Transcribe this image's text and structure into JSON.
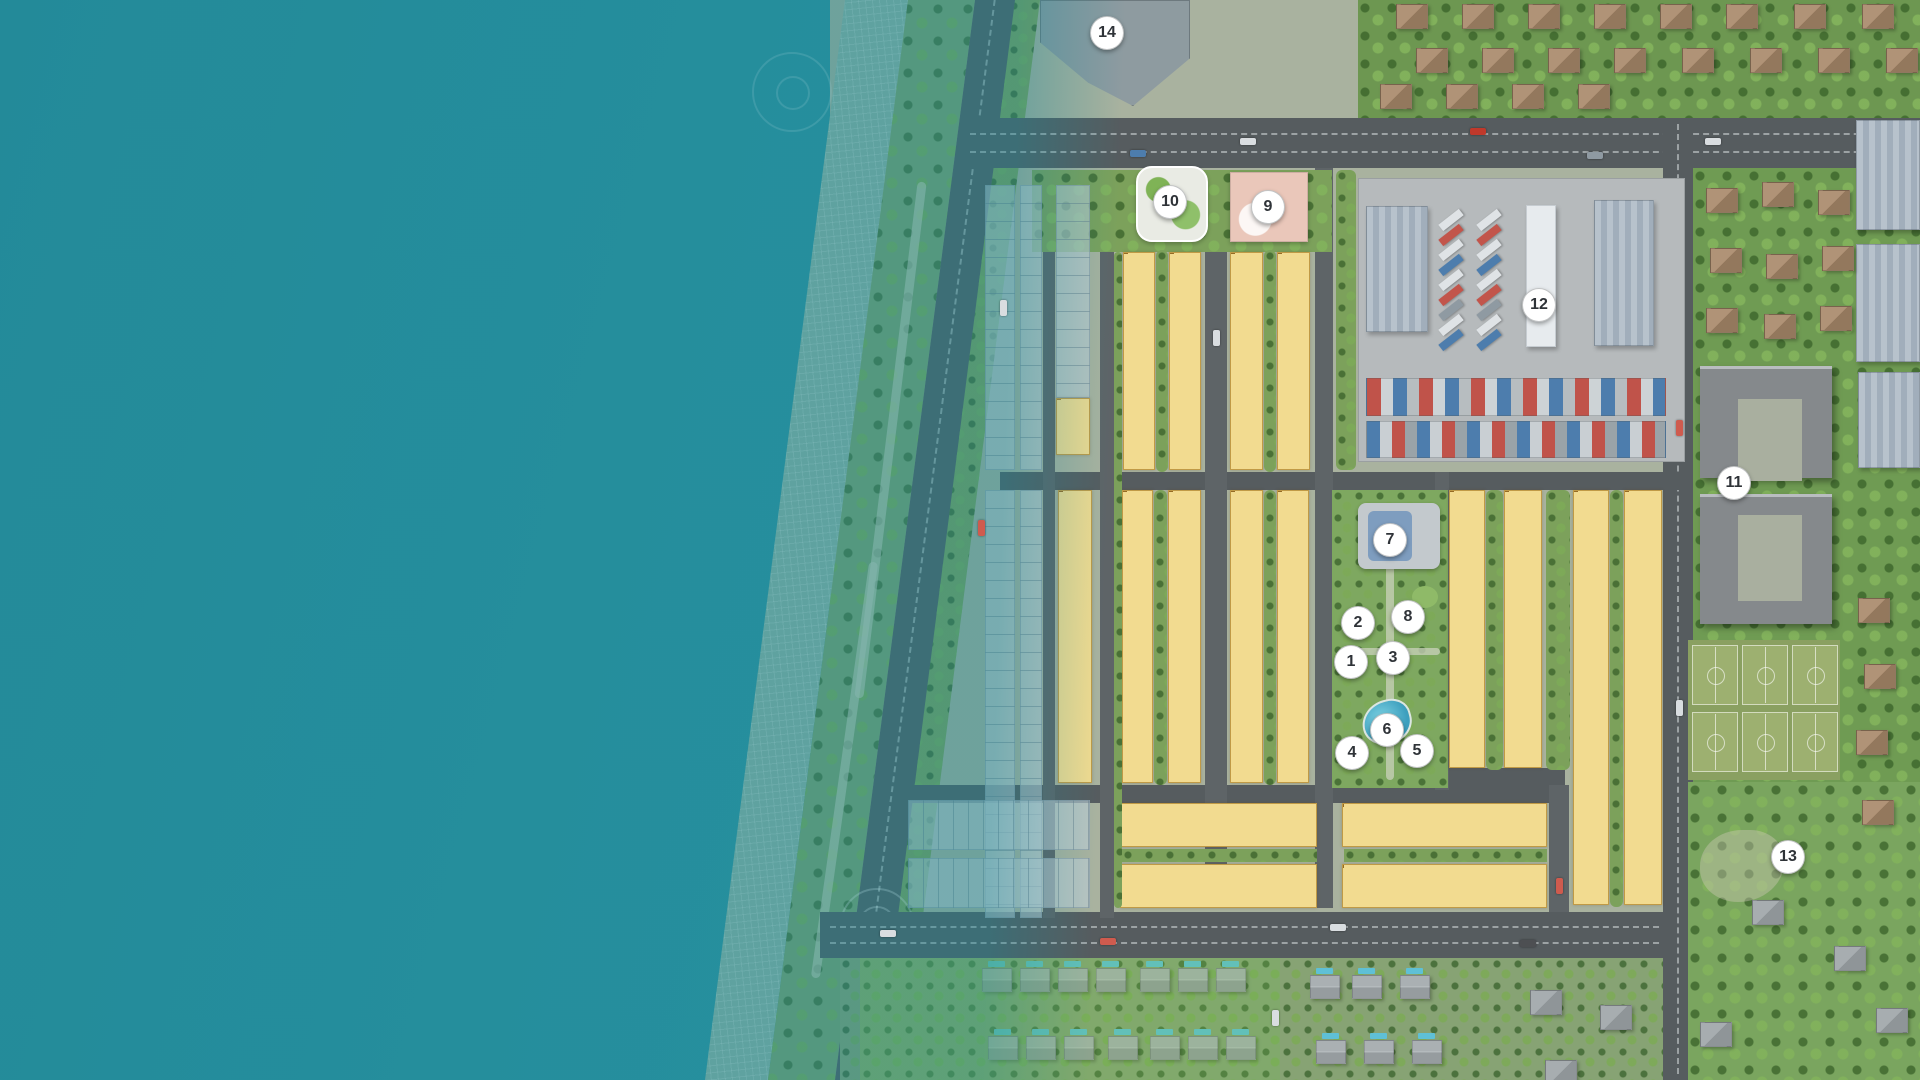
{
  "map_title": "coastal-resort-master-plan",
  "palette": {
    "sea": "#2f93a1",
    "lot_fill": "#f2db90",
    "lot_border": "#c09a46",
    "road": "#565c5f",
    "green": "#7ca15b",
    "marker_bg": "#ffffff",
    "marker_text": "#2f3338",
    "pool": "#5fc0d6",
    "school": "#eac7ba"
  },
  "markers": [
    {
      "num": "1",
      "x": 1351,
      "y": 662
    },
    {
      "num": "2",
      "x": 1358,
      "y": 623
    },
    {
      "num": "3",
      "x": 1393,
      "y": 658
    },
    {
      "num": "4",
      "x": 1352,
      "y": 753
    },
    {
      "num": "5",
      "x": 1417,
      "y": 751
    },
    {
      "num": "6",
      "x": 1387,
      "y": 730
    },
    {
      "num": "7",
      "x": 1390,
      "y": 540
    },
    {
      "num": "8",
      "x": 1408,
      "y": 617
    },
    {
      "num": "9",
      "x": 1268,
      "y": 207
    },
    {
      "num": "10",
      "x": 1170,
      "y": 202
    },
    {
      "num": "11",
      "x": 1734,
      "y": 483
    },
    {
      "num": "12",
      "x": 1539,
      "y": 305
    },
    {
      "num": "13",
      "x": 1788,
      "y": 857
    },
    {
      "num": "14",
      "x": 1107,
      "y": 33
    }
  ],
  "lots": {
    "vstrips": [
      {
        "id": "A",
        "prefix": "A",
        "from": 1,
        "to": 3,
        "value": "165.00",
        "ov": {
          "2": "169.00",
          "3": "256.30"
        }
      },
      {
        "id": "B-a",
        "prefix": "B",
        "from": 1,
        "to": 12,
        "value": "142.50",
        "ov": {
          "12": "165.10"
        }
      },
      {
        "id": "B-b",
        "prefix": "B",
        "from": 13,
        "to": 24,
        "value": "142.50",
        "ov": {
          "24": "169.50"
        }
      },
      {
        "id": "C-a",
        "prefix": "C",
        "from": 1,
        "to": 12,
        "value": "142.50",
        "ov": {
          "12": "165.10"
        }
      },
      {
        "id": "C-b",
        "prefix": "C",
        "from": 13,
        "to": 24,
        "value": "142.50",
        "ov": {
          "24": "189.50"
        }
      },
      {
        "id": "D",
        "prefix": "D",
        "from": 1,
        "to": 16,
        "value": "176.00",
        "ov": {
          "1": "304.70",
          "16": "322.00"
        }
      },
      {
        "id": "E-a",
        "prefix": "E",
        "from": 1,
        "to": 16,
        "value": "142.90",
        "ov": {
          "1": "177.10"
        }
      },
      {
        "id": "E-b",
        "prefix": "E",
        "from": 17,
        "to": 32,
        "value": "142.90",
        "ov": {
          "17": "177.90"
        }
      },
      {
        "id": "G-a",
        "prefix": "G",
        "from": 1,
        "to": 16,
        "value": "142.90",
        "ov": {
          "1": "177.90"
        }
      },
      {
        "id": "G-b",
        "prefix": "G",
        "from": 17,
        "to": 32,
        "value": "142.90",
        "ov": {
          "17": "177.90"
        }
      },
      {
        "id": "H-a",
        "prefix": "H",
        "from": 1,
        "to": 16,
        "value": "166.75",
        "ov": {
          "1": "249.60",
          "16": "322.20"
        }
      },
      {
        "id": "H-b",
        "prefix": "H",
        "from": 17,
        "to": 32,
        "value": "166.75",
        "ov": {
          "17": "249.00",
          "32": "316.90"
        }
      },
      {
        "id": "M-a",
        "prefix": "M",
        "from": 1,
        "to": 22,
        "value": "160.00",
        "ov": {
          "1": "242.40",
          "15": "168.00",
          "16": "168.00",
          "17": "168.00",
          "18": "168.00",
          "19": "168.00",
          "20": "168.00",
          "21": "168.00",
          "22": "256.90"
        }
      },
      {
        "id": "M-b",
        "prefix": "M",
        "from": 23,
        "to": 44,
        "value": "168.00",
        "ov": {
          "23": "256.00",
          "44": "252.70"
        }
      }
    ],
    "hblocks": [
      {
        "id": "K-top",
        "prefix": "K",
        "from": 1,
        "to": 12,
        "value": "145.00",
        "ov": {
          "1": "167.50",
          "12": "167.50"
        }
      },
      {
        "id": "K-bot",
        "prefix": "K",
        "from": 13,
        "to": 24,
        "value": "145.00",
        "ov": {
          "13": "167.50",
          "24": "167.50"
        }
      },
      {
        "id": "L-top",
        "prefix": "L",
        "from": 1,
        "to": 13,
        "value": "145.00",
        "ov": {
          "1": "167.50",
          "13": "190.00"
        }
      },
      {
        "id": "L-bot",
        "prefix": "L",
        "from": 14,
        "to": 26,
        "value": "145.00",
        "ov": {
          "14": "167.50",
          "26": "190.00"
        }
      }
    ]
  },
  "decor": {
    "trucks": {
      "cols": [
        1438,
        1476
      ],
      "y0": 216,
      "dy": 15,
      "count": 9,
      "colors": [
        "#dfe3e6",
        "#c2554b",
        "#dfe3e6",
        "#4d7dad",
        "#dfe3e6",
        "#c2554b",
        "#8f9aa2",
        "#dfe3e6",
        "#4d7dad"
      ]
    },
    "cars": [
      {
        "x": 1130,
        "y": 150,
        "c": "#4d7dad"
      },
      {
        "x": 1240,
        "y": 138,
        "c": "#d9dde0"
      },
      {
        "x": 1470,
        "y": 128,
        "c": "#c0392b"
      },
      {
        "x": 1587,
        "y": 152,
        "c": "#8f9aa2"
      },
      {
        "x": 1705,
        "y": 138,
        "c": "#d9dde0"
      },
      {
        "x": 1000,
        "y": 300,
        "c": "#d9dde0",
        "dir": "v"
      },
      {
        "x": 978,
        "y": 520,
        "c": "#cf5b4e",
        "dir": "v"
      },
      {
        "x": 1213,
        "y": 330,
        "c": "#d9dde0",
        "dir": "v"
      },
      {
        "x": 1556,
        "y": 878,
        "c": "#cf5b4e",
        "dir": "v"
      },
      {
        "x": 1676,
        "y": 420,
        "c": "#cf5b4e",
        "dir": "v"
      },
      {
        "x": 1676,
        "y": 700,
        "c": "#d9dde0",
        "dir": "v"
      },
      {
        "x": 880,
        "y": 930,
        "c": "#d9dde0"
      },
      {
        "x": 1100,
        "y": 938,
        "c": "#cf5b4e"
      },
      {
        "x": 1330,
        "y": 924,
        "c": "#d9dde0"
      },
      {
        "x": 1520,
        "y": 940,
        "c": "#4d4f52"
      },
      {
        "x": 1272,
        "y": 1010,
        "c": "#d9dde0",
        "dir": "v"
      }
    ],
    "villas": [
      [
        982,
        968
      ],
      [
        1020,
        968
      ],
      [
        1058,
        968
      ],
      [
        1096,
        968
      ],
      [
        1140,
        968
      ],
      [
        1178,
        968
      ],
      [
        1216,
        968
      ],
      [
        988,
        1036
      ],
      [
        1026,
        1036
      ],
      [
        1064,
        1036
      ],
      [
        1108,
        1036
      ],
      [
        1150,
        1036
      ],
      [
        1188,
        1036
      ],
      [
        1226,
        1036
      ],
      [
        1310,
        975
      ],
      [
        1352,
        975
      ],
      [
        1400,
        975
      ],
      [
        1316,
        1040
      ],
      [
        1364,
        1040
      ],
      [
        1412,
        1040
      ]
    ],
    "houses": [
      {
        "x": 1396,
        "y": 4,
        "c": "b"
      },
      {
        "x": 1462,
        "y": 4,
        "c": "b"
      },
      {
        "x": 1528,
        "y": 4,
        "c": "b"
      },
      {
        "x": 1594,
        "y": 4,
        "c": "b"
      },
      {
        "x": 1660,
        "y": 4,
        "c": "b"
      },
      {
        "x": 1726,
        "y": 4,
        "c": "b"
      },
      {
        "x": 1794,
        "y": 4,
        "c": "b"
      },
      {
        "x": 1862,
        "y": 4,
        "c": "b"
      },
      {
        "x": 1416,
        "y": 48,
        "c": "b"
      },
      {
        "x": 1482,
        "y": 48,
        "c": "b"
      },
      {
        "x": 1548,
        "y": 48,
        "c": "b"
      },
      {
        "x": 1614,
        "y": 48,
        "c": "b"
      },
      {
        "x": 1682,
        "y": 48,
        "c": "b"
      },
      {
        "x": 1750,
        "y": 48,
        "c": "b"
      },
      {
        "x": 1818,
        "y": 48,
        "c": "b"
      },
      {
        "x": 1886,
        "y": 48,
        "c": "b"
      },
      {
        "x": 1380,
        "y": 84,
        "c": "b"
      },
      {
        "x": 1446,
        "y": 84,
        "c": "b"
      },
      {
        "x": 1512,
        "y": 84,
        "c": "b"
      },
      {
        "x": 1578,
        "y": 84,
        "c": "b"
      },
      {
        "x": 1706,
        "y": 188,
        "c": "b"
      },
      {
        "x": 1762,
        "y": 182,
        "c": "b"
      },
      {
        "x": 1818,
        "y": 190,
        "c": "b"
      },
      {
        "x": 1710,
        "y": 248,
        "c": "b"
      },
      {
        "x": 1766,
        "y": 254,
        "c": "b"
      },
      {
        "x": 1822,
        "y": 246,
        "c": "b"
      },
      {
        "x": 1706,
        "y": 308,
        "c": "b"
      },
      {
        "x": 1764,
        "y": 314,
        "c": "b"
      },
      {
        "x": 1820,
        "y": 306,
        "c": "b"
      },
      {
        "x": 1858,
        "y": 598,
        "c": "b"
      },
      {
        "x": 1864,
        "y": 664,
        "c": "b"
      },
      {
        "x": 1856,
        "y": 730,
        "c": "b"
      },
      {
        "x": 1862,
        "y": 800,
        "c": "b"
      },
      {
        "x": 1752,
        "y": 900,
        "c": "g"
      },
      {
        "x": 1834,
        "y": 946,
        "c": "g"
      },
      {
        "x": 1876,
        "y": 1008,
        "c": "g"
      },
      {
        "x": 1700,
        "y": 1022,
        "c": "g"
      },
      {
        "x": 1530,
        "y": 990,
        "c": "g"
      },
      {
        "x": 1600,
        "y": 1005,
        "c": "g"
      },
      {
        "x": 1545,
        "y": 1060,
        "c": "g"
      }
    ]
  }
}
